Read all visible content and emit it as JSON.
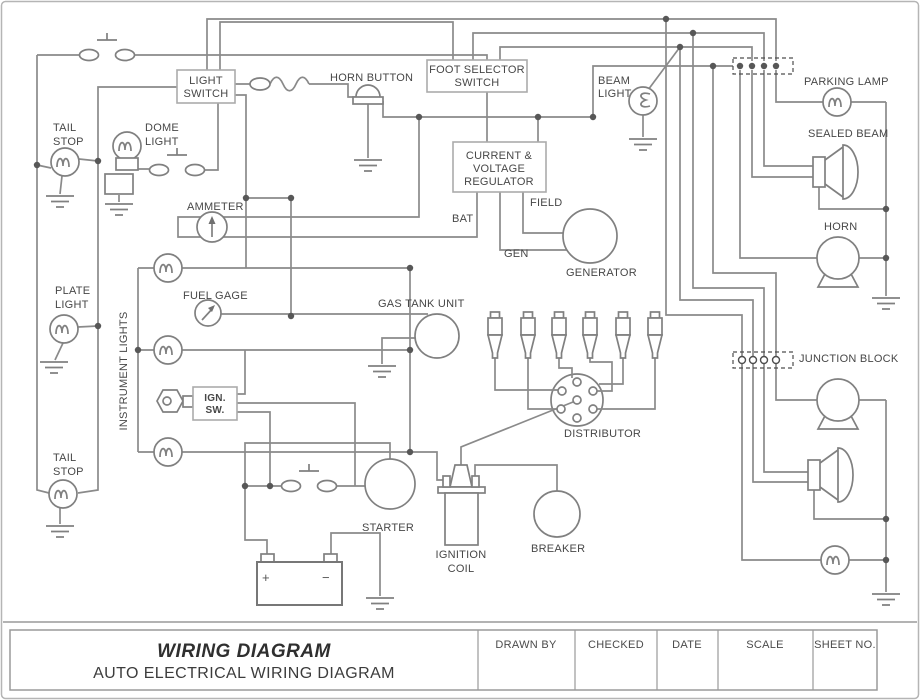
{
  "title_block": {
    "title": "WIRING DIAGRAM",
    "subtitle": "AUTO ELECTRICAL WIRING DIAGRAM",
    "columns": [
      "DRAWN BY",
      "CHECKED",
      "DATE",
      "SCALE",
      "SHEET NO."
    ]
  },
  "labels": {
    "tail_stop_upper": [
      "TAIL",
      "STOP"
    ],
    "dome_light": [
      "DOME",
      "LIGHT"
    ],
    "light_switch": [
      "LIGHT",
      "SWITCH"
    ],
    "horn_button": "HORN BUTTON",
    "foot_selector_switch": [
      "FOOT SELECTOR",
      "SWITCH"
    ],
    "beam_light": [
      "BEAM",
      "LIGHT"
    ],
    "parking_lamp": "PARKING LAMP",
    "sealed_beam": "SEALED BEAM",
    "horn": "HORN",
    "current_voltage_regulator": [
      "CURRENT &",
      "VOLTAGE",
      "REGULATOR"
    ],
    "field": "FIELD",
    "bat": "BAT",
    "gen": "GEN",
    "generator": "GENERATOR",
    "ammeter": "AMMETER",
    "plate_light": [
      "PLATE",
      "LIGHT"
    ],
    "instrument_lights": "INSTRUMENT LIGHTS",
    "fuel_gage": "FUEL GAGE",
    "gas_tank_unit": "GAS TANK UNIT",
    "ign_sw": [
      "IGN.",
      "SW."
    ],
    "distributor": "DISTRIBUTOR",
    "junction_block": "JUNCTION BLOCK",
    "tail_stop_lower": [
      "TAIL",
      "STOP"
    ],
    "starter": "STARTER",
    "ignition_coil": [
      "IGNITION",
      "COIL"
    ],
    "breaker": "BREAKER",
    "battery_positive": "+",
    "battery_negative": "−"
  },
  "colors": {
    "wire": "#8a8a8a",
    "symbol": "#808080",
    "box_border": "#abab ab",
    "text": "#474747",
    "junction_dot": "#575757"
  }
}
